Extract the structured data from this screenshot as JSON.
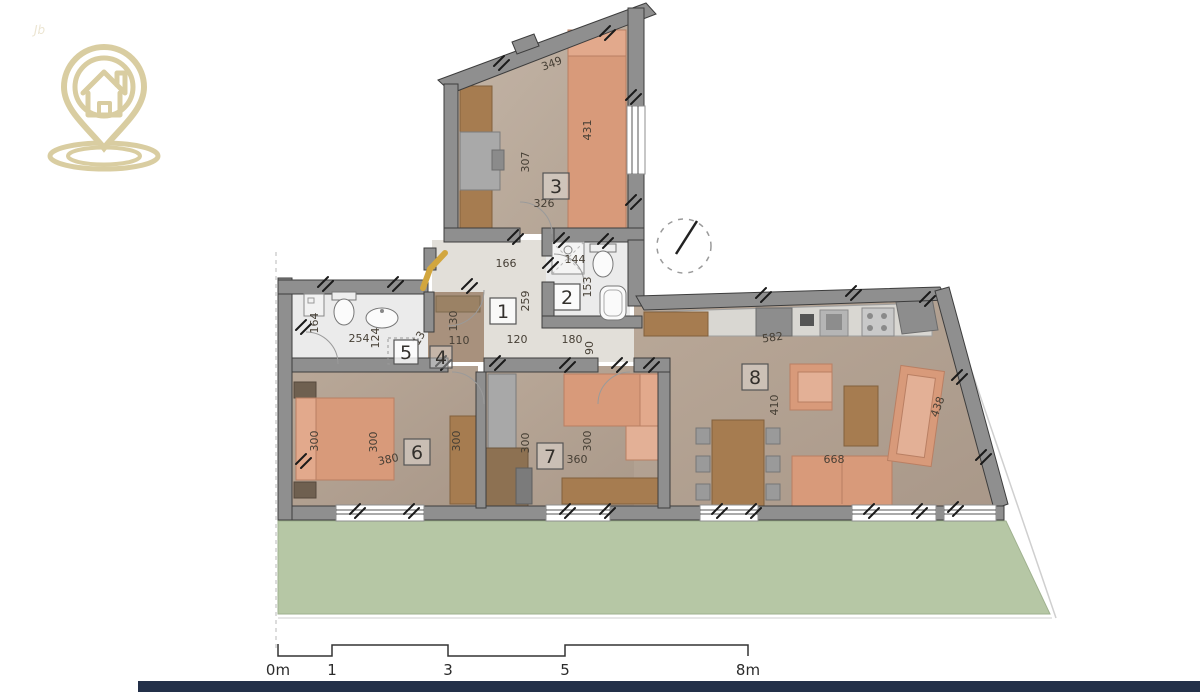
{
  "watermark": "Jb",
  "colors": {
    "logo_gold": "#d9cda1",
    "entry_arrow_gold": "#d2a63e",
    "terrace_green": "#b6c7a5",
    "footer_navy": "#233049",
    "wall_grey": "#8f8f8f",
    "wood_floor": "#b3a294",
    "furniture_salmon": "#d89a7a",
    "furniture_brown": "#a67c50"
  },
  "room_numbers": [
    "1",
    "2",
    "3",
    "4",
    "5",
    "6",
    "7",
    "8"
  ],
  "dims": [
    "349",
    "431",
    "307",
    "326",
    "166",
    "144",
    "153",
    "259",
    "120",
    "180",
    "90",
    "164",
    "254",
    "124",
    "13",
    "130",
    "110",
    "300",
    "300",
    "380",
    "300",
    "300",
    "300",
    "360",
    "582",
    "410",
    "668",
    "438"
  ],
  "scale": {
    "labels": [
      "0m",
      "1",
      "3",
      "5",
      "8m"
    ]
  }
}
